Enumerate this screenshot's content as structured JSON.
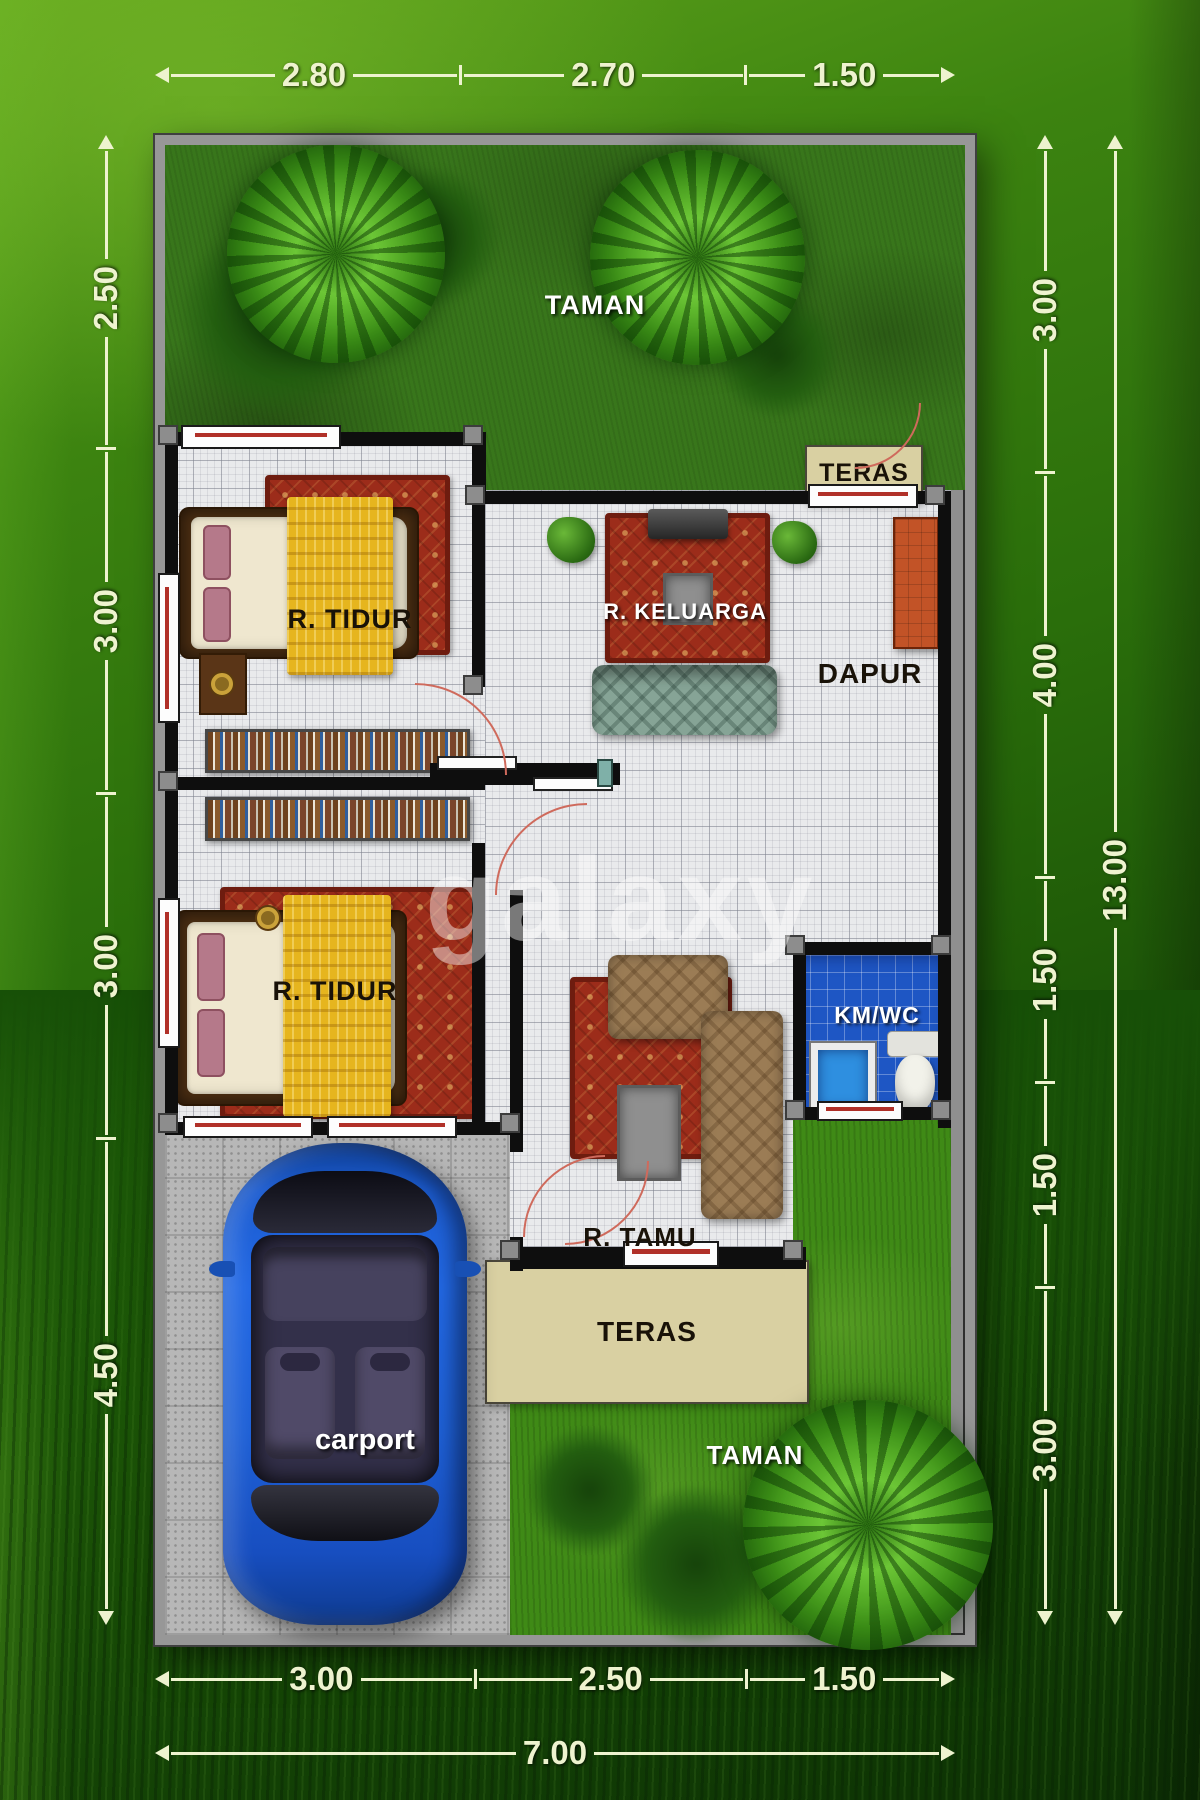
{
  "rooms": {
    "taman_top": "TAMAN",
    "teras_top": "TERAS",
    "bedroom1": "R. TIDUR",
    "keluarga": "R. KELUARGA",
    "dapur": "DAPUR",
    "bedroom2": "R. TIDUR",
    "kmwc": "KM/WC",
    "tamu": "R. TAMU",
    "teras_bottom": "TERAS",
    "taman_bottom": "TAMAN",
    "carport": "carport"
  },
  "watermark": "galaxy",
  "dimensions": {
    "top": [
      "2.80",
      "2.70",
      "1.50"
    ],
    "bottom": [
      "3.00",
      "2.50",
      "1.50"
    ],
    "bottom_total": "7.00",
    "left": [
      "2.50",
      "3.00",
      "3.00",
      "4.50"
    ],
    "right": [
      "3.00",
      "4.00",
      "1.50",
      "1.50",
      "3.00"
    ],
    "right_total": "13.00"
  },
  "colors": {
    "background_green": "#2a6e0b",
    "dimension_text": "#eef3cf",
    "wall_black": "#0e0e0e",
    "floor_tile": "#e9eaec",
    "grass_dark": "#38761b",
    "grass_bright": "#3f8a16",
    "carpet_red": "#9c2c1a",
    "blanket_yellow": "#e6b51e",
    "car_blue": "#2268e4",
    "kmwc_blue": "#1e56c4",
    "teras_beige": "#d9d0a2",
    "counter_orange": "#c25327"
  }
}
